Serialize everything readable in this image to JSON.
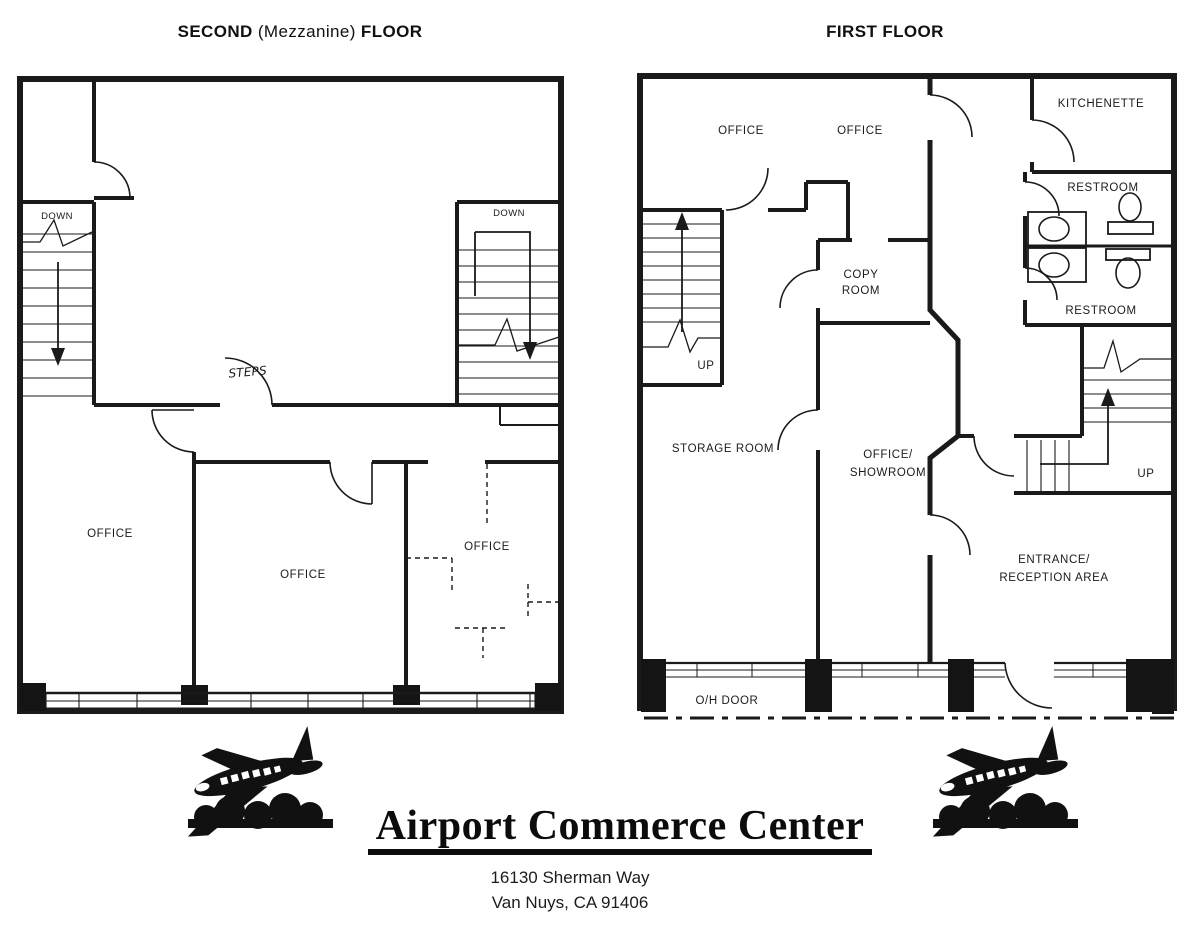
{
  "colors": {
    "ink": "#1a1a1a",
    "paper": "#ffffff"
  },
  "second_floor": {
    "title": {
      "prefix": "SECOND",
      "middle": "(Mezzanine)",
      "suffix": "FLOOR"
    },
    "labels": {
      "down_left": "DOWN",
      "down_right": "DOWN",
      "steps": "STEPS",
      "office_left": "OFFICE",
      "office_middle": "OFFICE",
      "office_right": "OFFICE"
    }
  },
  "first_floor": {
    "title": "FIRST FLOOR",
    "labels": {
      "office_left": "OFFICE",
      "office_right": "OFFICE",
      "kitchenette": "KITCHENETTE",
      "restroom_top": "RESTROOM",
      "restroom_bottom": "RESTROOM",
      "copy_line1": "COPY",
      "copy_line2": "ROOM",
      "up_left": "UP",
      "up_right": "UP",
      "storage": "STORAGE ROOM",
      "showroom_line1": "OFFICE/",
      "showroom_line2": "SHOWROOM",
      "entrance_line1": "ENTRANCE/",
      "entrance_line2": "RECEPTION AREA",
      "oh_door": "O/H DOOR"
    }
  },
  "branding": {
    "name": "Airport Commerce Center",
    "address_line1": "16130 Sherman Way",
    "address_line2": "Van Nuys, CA 91406"
  }
}
